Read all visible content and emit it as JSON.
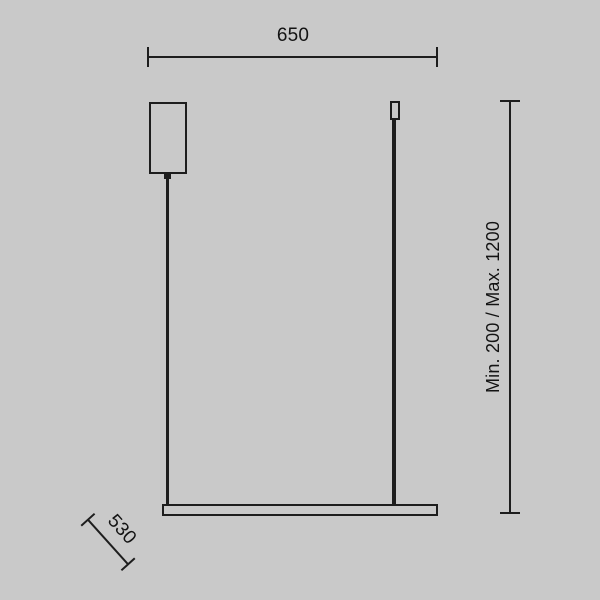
{
  "drawing": {
    "type": "pendant-lamp-dimension-drawing",
    "dimensions": {
      "top_width": "650",
      "side_height": "Min. 200 / Max. 1200",
      "bottom_depth": "530"
    }
  },
  "colors": {
    "background": "#c9c9c9",
    "line": "#1d1d1d",
    "text": "#131313"
  }
}
